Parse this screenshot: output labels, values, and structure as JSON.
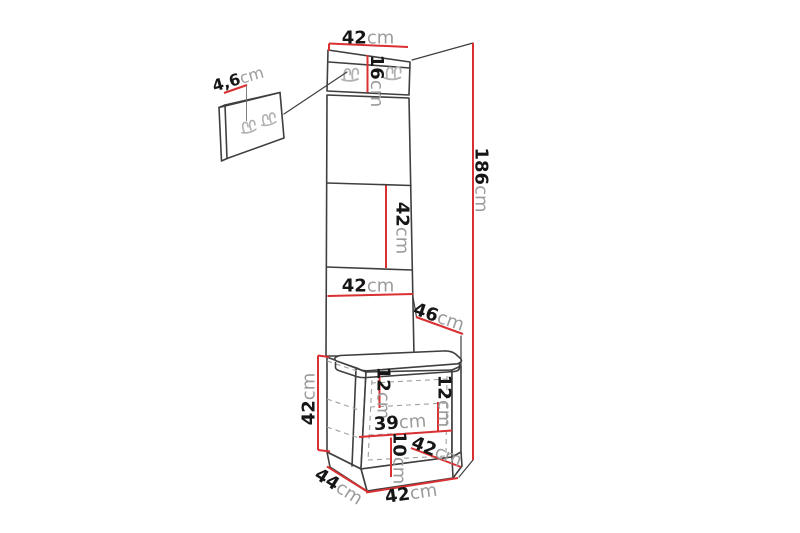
{
  "diagram": {
    "type": "furniture-dimension-diagram",
    "subject": "hallway unit with coat-hook panel and storage bench",
    "colors": {
      "dimension_line": "#d93032",
      "outline": "#3f3f3f",
      "hook": "#b2b2b2",
      "number_text": "#161616",
      "unit_text": "#9b9b9b",
      "background": "#ffffff"
    },
    "icons": {
      "coat_hook": "coat-hook-icon"
    }
  },
  "labels": {
    "top_width": {
      "value": "42",
      "unit": "cm"
    },
    "hook_panel_height": {
      "value": "16",
      "unit": "cm"
    },
    "hook_detail_width": {
      "value": "4,6",
      "unit": "cm"
    },
    "total_height": {
      "value": "186",
      "unit": "cm"
    },
    "middle_panel_height": {
      "value": "42",
      "unit": "cm"
    },
    "panel_width": {
      "value": "42",
      "unit": "cm"
    },
    "seat_depth": {
      "value": "46",
      "unit": "cm"
    },
    "bench_height": {
      "value": "42",
      "unit": "cm"
    },
    "shelf_top_height": {
      "value": "12",
      "unit": "cm"
    },
    "shelf_right_height": {
      "value": "12",
      "unit": "cm"
    },
    "interior_width": {
      "value": "39",
      "unit": "cm"
    },
    "shelf_bottom_height": {
      "value": "10",
      "unit": "cm"
    },
    "bench_top_depth": {
      "value": "42",
      "unit": "cm"
    },
    "bench_depth": {
      "value": "44",
      "unit": "cm"
    },
    "bench_width": {
      "value": "42",
      "unit": "cm"
    }
  }
}
